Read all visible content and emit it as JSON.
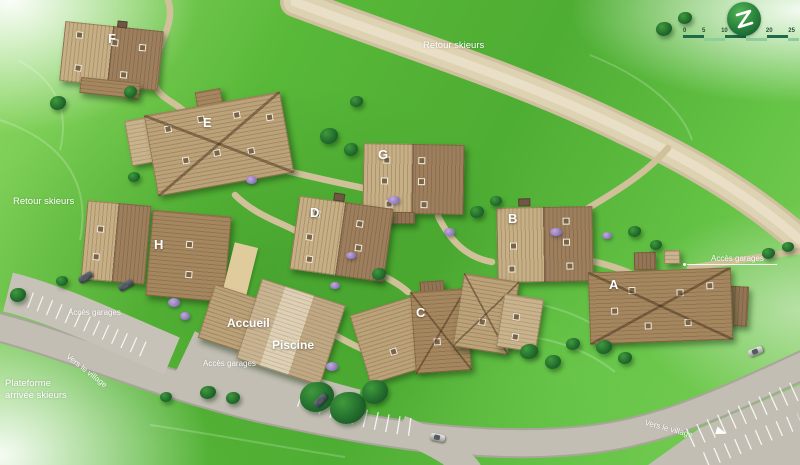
{
  "scalebar": {
    "ticks": [
      "0",
      "5",
      "10",
      "15",
      "20",
      "25"
    ]
  },
  "logo": {
    "icon": "leaf-z-logo"
  },
  "labels": {
    "retour_top": "Retour skieurs",
    "retour_left": "Retour skieurs",
    "acces_left": "Accès garages",
    "acces_center": "Accès garages",
    "acces_right": "Accès garages",
    "vers_left": "Vers le village",
    "vers_right": "Vers le village",
    "plateforme_line1": "Plateforme",
    "plateforme_line2": "arrivée skieurs"
  },
  "facilities": {
    "accueil": "Accueil",
    "piscine": "Piscine"
  },
  "buildings": [
    {
      "label": "A"
    },
    {
      "label": "B"
    },
    {
      "label": "C"
    },
    {
      "label": "D"
    },
    {
      "label": "E"
    },
    {
      "label": "F"
    },
    {
      "label": "G"
    },
    {
      "label": "H"
    }
  ],
  "colors": {
    "terrain_green": "#54b637",
    "trail_beige": "#ddd2b2",
    "road_gray": "#c2beb3",
    "roof_light": "#c6ae85",
    "roof_dark": "#9d7f5e",
    "logo_green": "#267f3a",
    "scale_dark": "#1c6b4a",
    "scale_light": "#8fce9b"
  }
}
